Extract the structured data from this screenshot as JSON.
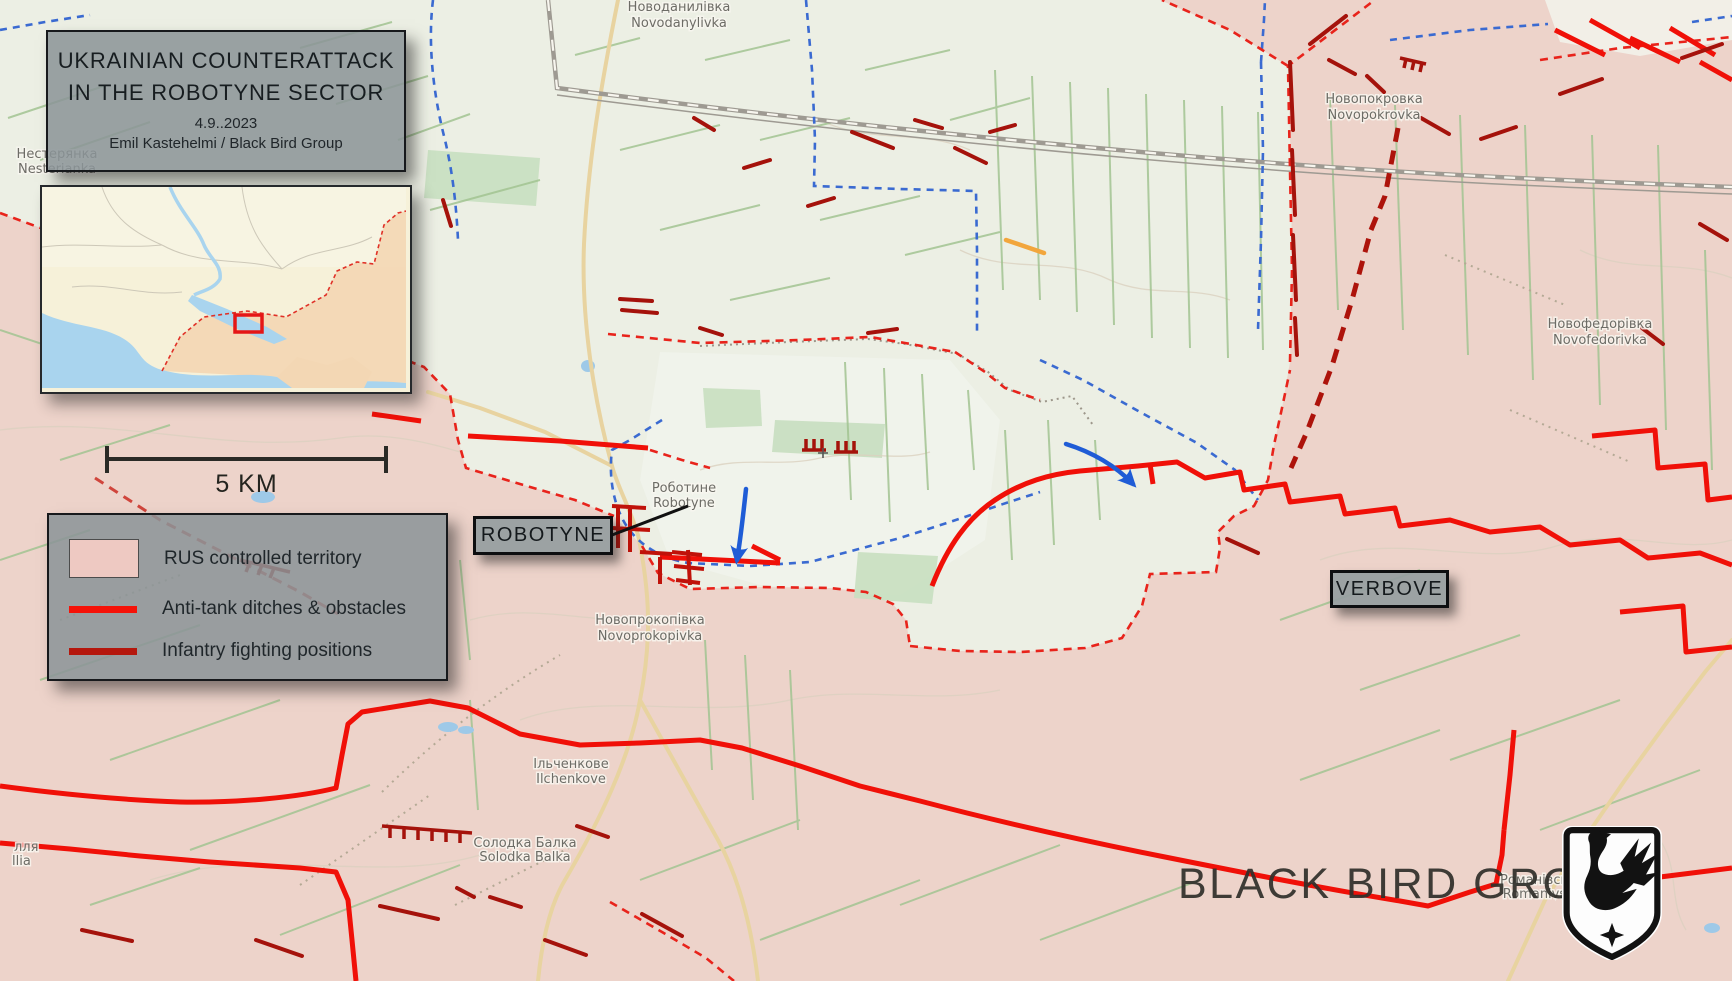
{
  "title_box": {
    "line1": "UKRAINIAN COUNTERATTACK",
    "line2": "IN THE ROBOTYNE SECTOR",
    "date": "4.9..2023",
    "credit": "Emil Kastehelmi / Black Bird Group"
  },
  "scale_bar": {
    "label": "5 KM"
  },
  "legend": {
    "items": [
      {
        "label": "RUS controlled territory",
        "swatch_color": "#eec9c2"
      },
      {
        "label": "Anti-tank ditches & obstacles",
        "swatch_color": "#f51208"
      },
      {
        "label": "Infantry fighting positions",
        "swatch_color": "#b5170d"
      }
    ]
  },
  "callouts": {
    "robotyne": "ROBOTYNE",
    "verbove": "VERBOVE"
  },
  "watermark": {
    "text": "BLACK BIRD GROUP"
  },
  "map_labels": [
    {
      "uk": "Новоданилівка",
      "en": "Novodanylivka"
    },
    {
      "uk": "Нестерянка",
      "en": "Nesterianka"
    },
    {
      "uk": "Новопокровка",
      "en": "Novopokrovka"
    },
    {
      "uk": "Новофедорівка",
      "en": "Novofedorivka"
    },
    {
      "uk": "Роботине",
      "en": "Robotyne"
    },
    {
      "uk": "Новопрокопівка",
      "en": "Novoprokopivka"
    },
    {
      "uk": "Ільченкове",
      "en": "Ilchenkove"
    },
    {
      "uk": "Солодка Балка",
      "en": "Solodka Balka"
    },
    {
      "uk": "Романівське",
      "en": "Romanivske"
    },
    {
      "uk": "лля",
      "en": "llia"
    }
  ],
  "colors": {
    "rus_territory": "#eac0b8",
    "anti_tank_ditch": "#f01008",
    "infantry_position": "#a5120b",
    "rus_frontline": "#e8231b",
    "ukr_frontline": "#3a6ad1",
    "ukr_attack_arrow": "#1f5cd6",
    "orange_marker": "#f2a63c"
  }
}
